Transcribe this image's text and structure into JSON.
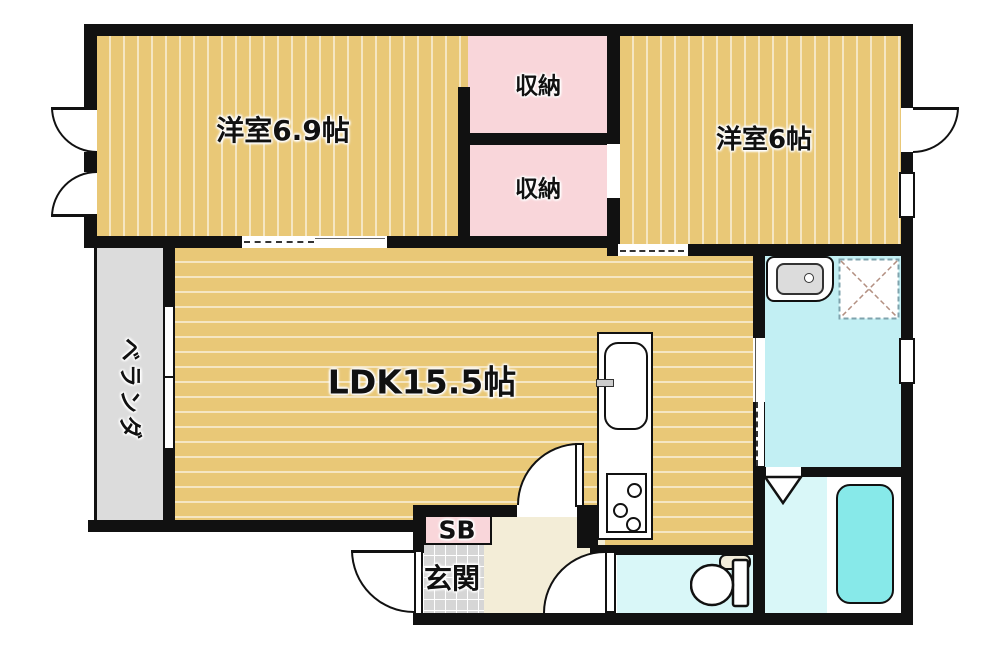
{
  "plan_title": "2LDK apartment floor plan",
  "rooms": {
    "western_room_69": {
      "label": "洋室6.9帖"
    },
    "closet_upper": {
      "label": "収納"
    },
    "closet_lower": {
      "label": "収納"
    },
    "western_room_6": {
      "label": "洋室6帖"
    },
    "ldk": {
      "label": "LDK15.5帖"
    },
    "veranda": {
      "label": "ベランダ"
    },
    "shoebox": {
      "label": "SB"
    },
    "entrance": {
      "label": "玄関"
    }
  },
  "fixtures": [
    "kitchen-sink",
    "gas-stove",
    "washbasin",
    "washing-machine-pan",
    "bathtub",
    "toilet"
  ],
  "colors": {
    "wall": "#111111",
    "wood_floor": "#e9c877",
    "closet_pink": "#f9d6da",
    "washroom_cyan": "#c2eff3",
    "bath_pale_cyan": "#d9f7f8",
    "bathtub_cyan": "#87e9e9",
    "veranda_gray": "#dcdcdc",
    "entrance_tile_gray": "#d6d6d6",
    "hall_cream": "#f3edd7"
  }
}
